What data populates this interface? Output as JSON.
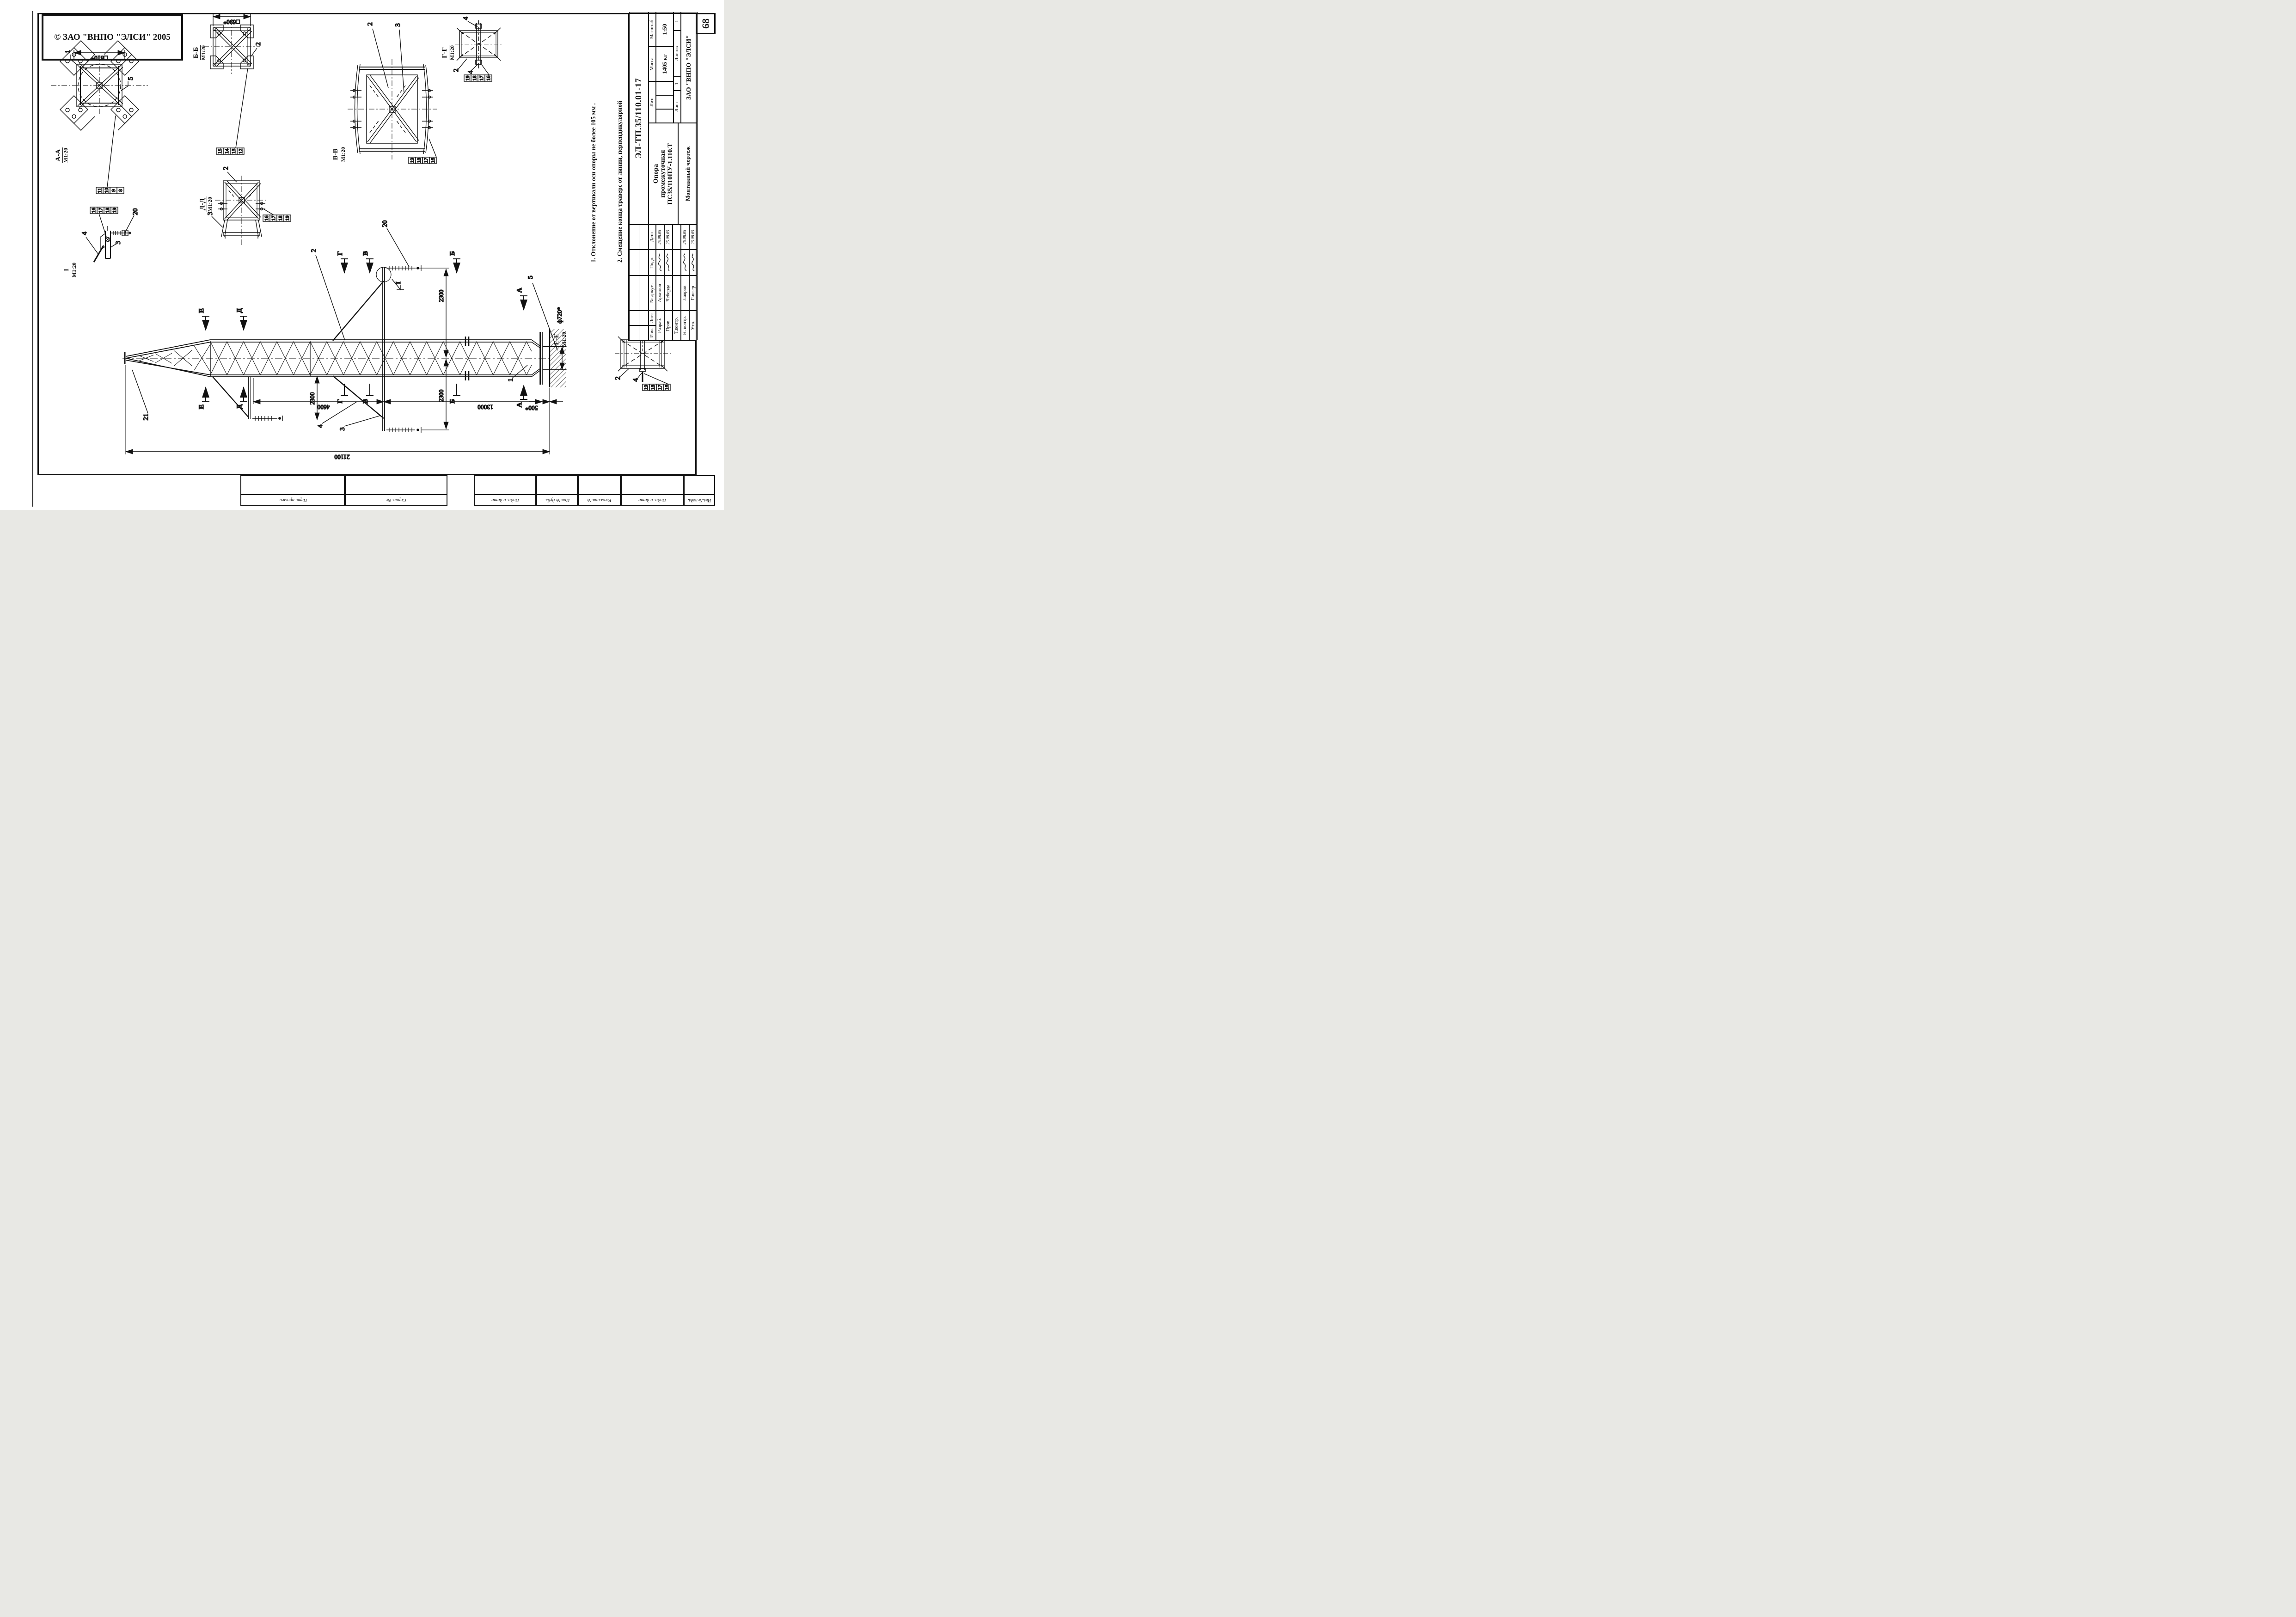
{
  "copyright": "© ЗАО \"ВНПО \"ЭЛСИ\" 2005",
  "page_number": "68",
  "scale_common": "М1:20",
  "views": {
    "aa": {
      "name": "А-А",
      "scale": "М1:20"
    },
    "bb": {
      "name": "Б-Б",
      "scale": "М1:20"
    },
    "vv": {
      "name": "В-В",
      "scale": "М1:20"
    },
    "gg": {
      "name": "Г-Г",
      "scale": "М1:20"
    },
    "dd": {
      "name": "Д-Д",
      "scale": "М1:20"
    },
    "ee": {
      "name": "Е-Е",
      "scale": "М1:20"
    },
    "i": {
      "name": "I",
      "scale": "М1:20"
    }
  },
  "sections": {
    "a": "А",
    "b": "Б",
    "v": "В",
    "g": "Г",
    "d": "Д",
    "e": "Е"
  },
  "callouts": {
    "n1": "1",
    "n2": "2",
    "n3": "3",
    "n4": "4",
    "n5": "5",
    "n20": "20",
    "n21": "21"
  },
  "dims": {
    "sq810": "□810*",
    "sq690": "□690*",
    "v2300": "2300",
    "h4600": "4600",
    "h13000": "13000",
    "h21100": "21100",
    "h500": "500*",
    "d720": "ф720*"
  },
  "part_tables": {
    "aa": [
      "11",
      "10",
      "9",
      "8"
    ],
    "bb": [
      "15",
      "14",
      "13",
      "12"
    ],
    "vv": [
      "19",
      "18",
      "17",
      "16"
    ],
    "gg": [
      "19",
      "18",
      "17",
      "16"
    ],
    "dd": [
      "16",
      "17",
      "18",
      "19"
    ],
    "i": [
      "16",
      "17",
      "18",
      "19"
    ],
    "ee": [
      "19",
      "18",
      "17",
      "16"
    ]
  },
  "notes": {
    "l1": "1. Отклонение от вертикали оси опоры не более 105 мм .",
    "l2": "2. Смещение конца траверс от линии, перпендикулярной",
    "l3": "    оси трассы не более 100 мм.",
    "l4": "3.*Размеры для справок."
  },
  "title_block": {
    "doc_number": "ЭЛ-ТП.35/110.01-17",
    "product_name_1": "Опора",
    "product_name_2": "промежуточная",
    "product_name_3": "ПС35/110ПУ-1.110.Т",
    "doc_type": "Монтажный чертеж",
    "company": "ЗАО \"ВНПО \"ЭЛСИ\"",
    "headers": {
      "izm": "Изм.",
      "list": "Лист",
      "doc": "№ докум.",
      "sign": "Подп.",
      "date": "Дата",
      "lit": "Лит.",
      "mass": "Масса",
      "scale": "Масштаб",
      "sheet": "Лист",
      "sheets": "Листов"
    },
    "values": {
      "mass": "1405 кг",
      "scale": "1:50",
      "sheet": "1",
      "sheets": "1"
    },
    "rows": [
      {
        "role": "Разраб.",
        "name": "Архипов",
        "date": "25.08.05"
      },
      {
        "role": "Пров.",
        "name": "Чеберда",
        "date": "25.08.05"
      },
      {
        "role": "Т.контр.",
        "name": "",
        "date": ""
      },
      {
        "role": "Н. контр.",
        "name": "Лавров",
        "date": "26.08.05"
      },
      {
        "role": "Утв.",
        "name": "Гинзер",
        "date": "26.08.05"
      }
    ]
  },
  "edge_stam_note": "frame edge stamps",
  "edge_stamps": [
    "Перв. примен.",
    "Справ. №",
    "Подп. и дата",
    "Инв.№ дубл.",
    "Взам.инв.№",
    "Подп. и дата",
    "Инв.№ подл."
  ]
}
